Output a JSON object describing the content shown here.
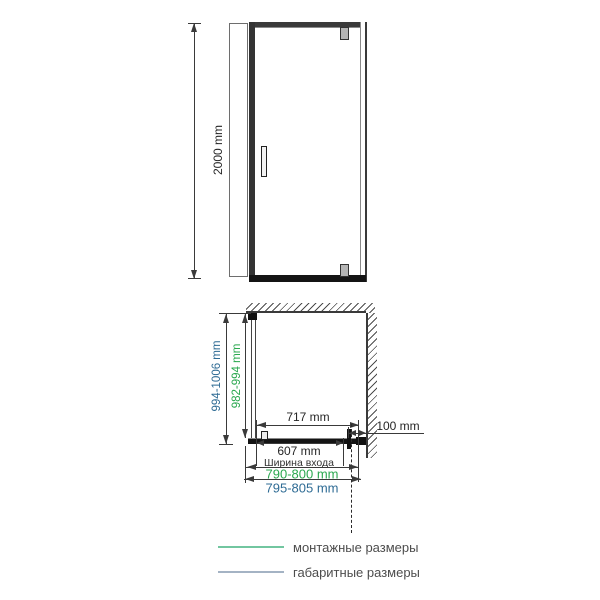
{
  "colors": {
    "line_dark": "#3a3a3a",
    "mounting_green": "#2aa84f",
    "overall_teal": "#2e6b94",
    "legend_green_line": "#72c6a0",
    "legend_blue_line": "#a4b3c4"
  },
  "front_view": {
    "height_label": "2000 mm"
  },
  "plan_view": {
    "depth_overall_label": "994-1006 mm",
    "depth_mounting_label": "982-994 mm",
    "door_width_label": "717 mm",
    "wall_offset_label": "100 mm",
    "entrance_width_label": "607 mm",
    "entrance_width_caption": "Ширина входа",
    "width_mounting_label": "790-800 mm",
    "width_overall_label": "795-805 mm"
  },
  "legend": {
    "items": [
      {
        "label": "монтажные размеры",
        "meaning": "mounting dimensions"
      },
      {
        "label": "габаритные размеры",
        "meaning": "overall dimensions"
      }
    ]
  }
}
